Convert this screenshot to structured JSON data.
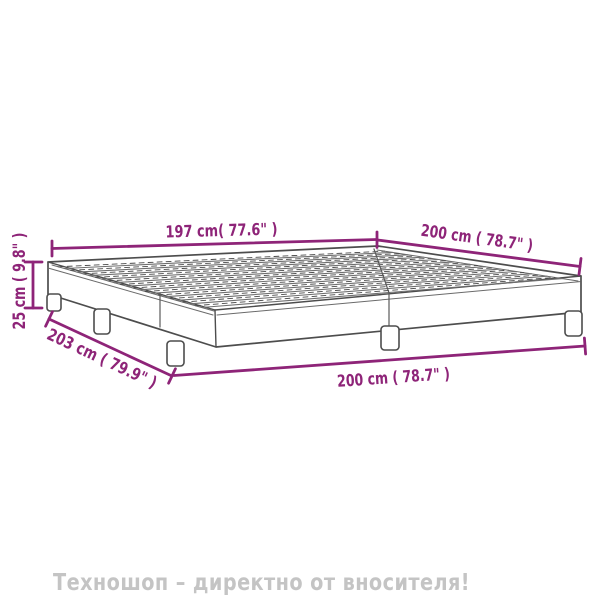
{
  "diagram": {
    "accent_color": "#8e2478",
    "outline_color": "#4d4d4d",
    "slat_color": "#6f6f6f",
    "dimensions": {
      "slat_width": {
        "label": "197 cm( 77.6\" )",
        "cm": 197,
        "inches": 77.6
      },
      "length_top": {
        "label": "200 cm ( 78.7\" )",
        "cm": 200,
        "inches": 78.7
      },
      "height": {
        "label": "25 cm ( 9.8\" )",
        "cm": 25,
        "inches": 9.8
      },
      "length_side": {
        "label": "203 cm ( 79.9\" )",
        "cm": 203,
        "inches": 79.9
      },
      "width_front": {
        "label": "200 cm ( 78.7\" )",
        "cm": 200,
        "inches": 78.7
      }
    }
  },
  "watermark": {
    "text": "Техношоп – директно от вносителя!",
    "color": "#c4c4c4"
  }
}
